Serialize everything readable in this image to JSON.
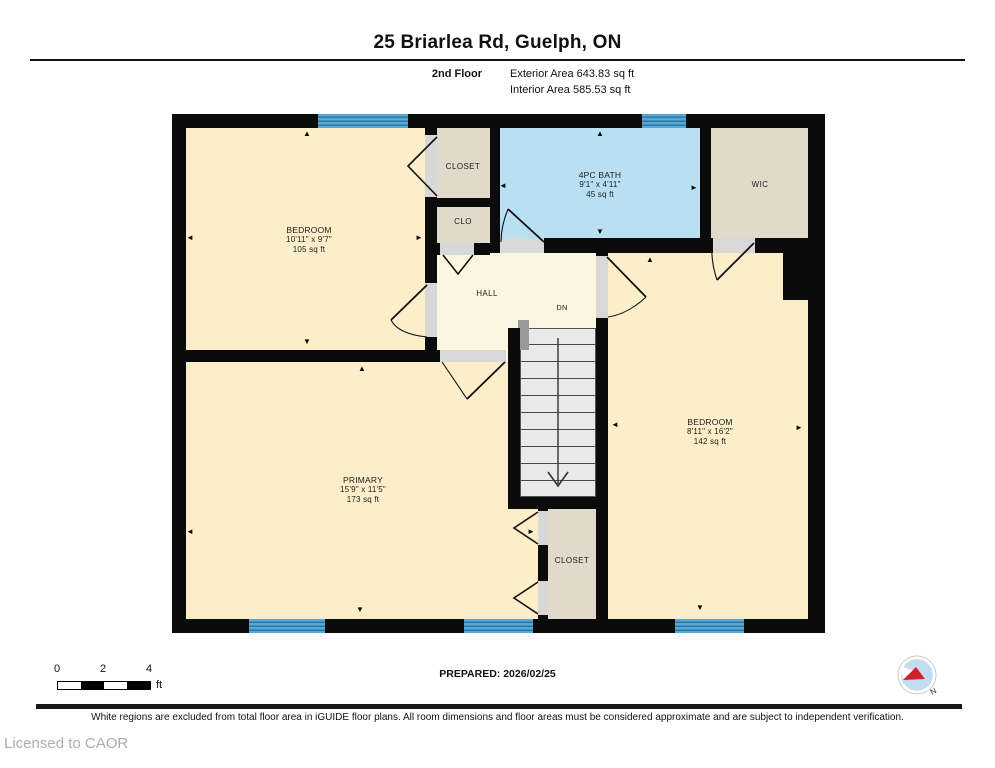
{
  "header": {
    "title": "25 Briarlea Rd, Guelph, ON",
    "floor_label": "2nd Floor",
    "exterior_area": "Exterior Area 643.83 sq ft",
    "interior_area": "Interior Area 585.53 sq ft"
  },
  "rooms": {
    "bedroom_tl": {
      "name": "BEDROOM",
      "dims": "10'11\" x 9'7\"",
      "area": "105 sq ft"
    },
    "closet_top": {
      "name": "CLOSET"
    },
    "clo": {
      "name": "CLO"
    },
    "bath": {
      "name": "4PC BATH",
      "dims": "9'1\" x 4'11\"",
      "area": "45 sq ft"
    },
    "wic": {
      "name": "WIC"
    },
    "hall": {
      "name": "HALL"
    },
    "stairs": {
      "label": "DN"
    },
    "bedroom_right": {
      "name": "BEDROOM",
      "dims": "8'11\" x 16'2\"",
      "area": "142 sq ft"
    },
    "primary": {
      "name": "PRIMARY",
      "dims": "15'9\" x 11'5\"",
      "area": "173 sq ft"
    },
    "closet_bottom": {
      "name": "CLOSET"
    }
  },
  "plan": {
    "markers": [
      {
        "g": "▲",
        "x": 307,
        "y": 134
      },
      {
        "g": "◄",
        "x": 190,
        "y": 238
      },
      {
        "g": "►",
        "x": 419,
        "y": 238
      },
      {
        "g": "▼",
        "x": 307,
        "y": 342
      },
      {
        "g": "▲",
        "x": 362,
        "y": 369
      },
      {
        "g": "◄",
        "x": 190,
        "y": 532
      },
      {
        "g": "▼",
        "x": 360,
        "y": 610
      },
      {
        "g": "▲",
        "x": 600,
        "y": 134
      },
      {
        "g": "◄",
        "x": 503,
        "y": 186
      },
      {
        "g": "►",
        "x": 694,
        "y": 188
      },
      {
        "g": "▼",
        "x": 600,
        "y": 232
      },
      {
        "g": "▲",
        "x": 650,
        "y": 260
      },
      {
        "g": "◄",
        "x": 615,
        "y": 425
      },
      {
        "g": "►",
        "x": 799,
        "y": 428
      },
      {
        "g": "▼",
        "x": 700,
        "y": 608
      },
      {
        "g": "►",
        "x": 531,
        "y": 532
      }
    ]
  },
  "footer": {
    "scale": {
      "ticks": [
        "0",
        "2",
        "4"
      ],
      "unit": "ft"
    },
    "prepared": "PREPARED: 2026/02/25",
    "compass_label": "N",
    "disclaimer": "White regions are excluded from total floor area in iGUIDE floor plans. All room dimensions and floor areas must be considered approximate and are subject to independent verification.",
    "license": "Licensed to CAOR"
  },
  "colors": {
    "wall": "#0b0b0b",
    "room": "#fbeec8",
    "hall": "#fcf6e0",
    "bath": "#b9dff2",
    "closet": "#e1dacb",
    "window": "#57a8d6",
    "windowline": "#2b77a3",
    "open": "#d8d8d8",
    "stair": "#e9e9e9"
  }
}
